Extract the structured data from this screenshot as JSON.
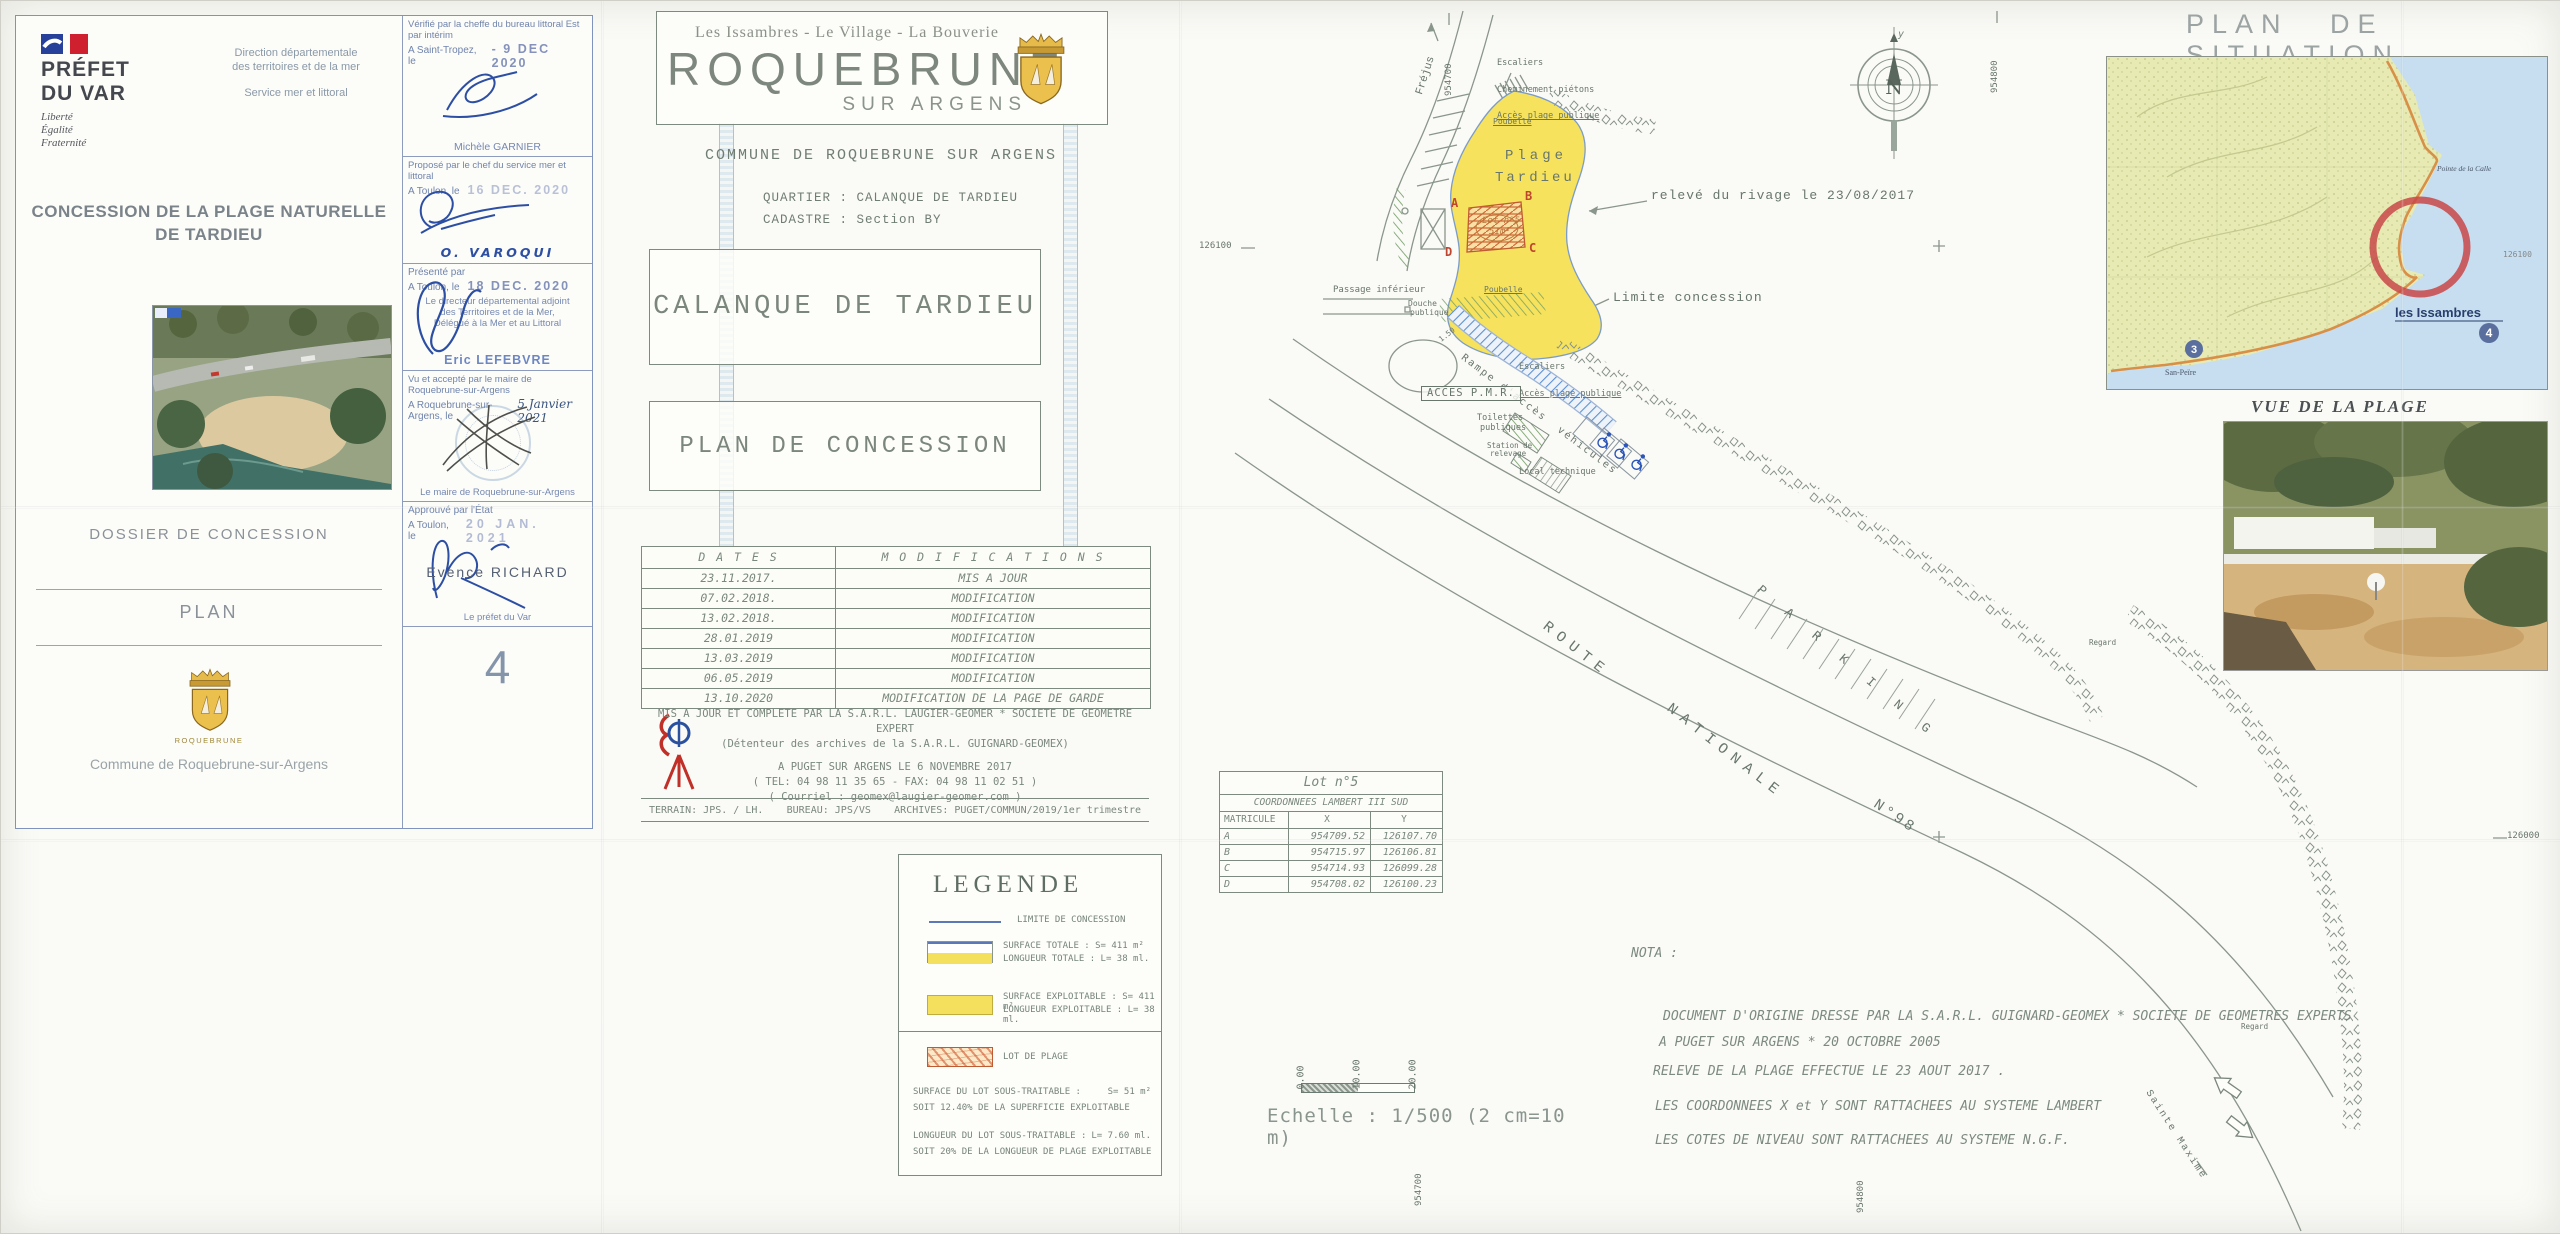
{
  "sheet": {
    "number": "4"
  },
  "prefet_block": {
    "name_line1": "PRÉFET",
    "name_line2": "DU VAR",
    "motto_1": "Liberté",
    "motto_2": "Égalité",
    "motto_3": "Fraternité",
    "direction_line1": "Direction départementale",
    "direction_line2": "des territoires et de la mer",
    "service": "Service mer et littoral",
    "title_line1": "CONCESSION DE LA PLAGE NATURELLE",
    "title_line2": "DE TARDIEU",
    "dossier": "DOSSIER DE CONCESSION",
    "plan": "PLAN",
    "logo_caption": "ROQUEBRUNE",
    "commune": "Commune de Roquebrune-sur-Argens"
  },
  "stamps": {
    "verifie": {
      "line1": "Vérifié par la cheffe du bureau littoral Est par intérim",
      "line2": "A Saint-Tropez, le",
      "date": "- 9 DEC 2020",
      "signatory": "Michèle GARNIER"
    },
    "propose": {
      "line1": "Proposé par le chef du service mer et littoral",
      "line2": "A Toulon, le",
      "date": "16 DEC. 2020",
      "signatory": "O. VAROQUI"
    },
    "presente": {
      "line1": "Présenté par",
      "line2": "A Toulon, le",
      "date": "18 DEC. 2020",
      "role": [
        "Le directeur départemental adjoint",
        "des Territoires et de la Mer,",
        "Délégué à la Mer et au Littoral"
      ],
      "signatory": "Eric LEFEBVRE"
    },
    "vu_accepte": {
      "line1": "Vu et accepté par le maire de Roquebrune-sur-Argens",
      "line2": "A Roquebrune-sur-Argens, le",
      "date_hand": "5 Janvier 2021",
      "signatory": "Le maire de Roquebrune-sur-Argens"
    },
    "approuve": {
      "line1": "Approuvé par l'État",
      "line2": "A Toulon, le",
      "date": "20 JAN. 2021",
      "signatory": "Evence RICHARD",
      "role": "Le préfet du Var"
    },
    "sheet_number": "4"
  },
  "title_block": {
    "banner_top": "Les Issambres - Le Village - La Bouverie",
    "banner_name": "ROQUEBRUNE",
    "banner_sub": "SUR ARGENS",
    "commune": "COMMUNE DE ROQUEBRUNE SUR ARGENS",
    "quartier": "QUARTIER : CALANQUE DE TARDIEU",
    "cadastre": "CADASTRE : Section BY",
    "main_title": "CALANQUE DE TARDIEU",
    "subtitle": "PLAN DE CONCESSION"
  },
  "modifications": {
    "header_dates": "D A T E S",
    "header_modifications": "M O D I F I C A T I O N S",
    "rows": [
      {
        "date": "23.11.2017.",
        "modification": "MIS A JOUR"
      },
      {
        "date": "07.02.2018.",
        "modification": "MODIFICATION"
      },
      {
        "date": "13.02.2018.",
        "modification": "MODIFICATION"
      },
      {
        "date": "28.01.2019",
        "modification": "MODIFICATION"
      },
      {
        "date": "13.03.2019",
        "modification": "MODIFICATION"
      },
      {
        "date": "06.05.2019",
        "modification": "MODIFICATION"
      },
      {
        "date": "13.10.2020",
        "modification": "MODIFICATION DE LA PAGE DE GARDE"
      }
    ]
  },
  "surveyor": {
    "line1": "MIS A JOUR ET COMPLETE PAR LA S.A.R.L. LAUGIER-GEOMER * SOCIETE DE GEOMETRE EXPERT",
    "line2": "(Détenteur des archives de la S.A.R.L. GUIGNARD-GEOMEX)",
    "line3": "A PUGET SUR ARGENS LE 6 NOVEMBRE 2017",
    "line4": "( TEL: 04 98 11 35 65  -  FAX: 04 98 11 02 51 )",
    "line5": "( Courriel : geomex@laugier-geomer.com )",
    "terrain": "TERRAIN:  JPS. / LH.",
    "bureau": "BUREAU:  JPS/VS",
    "archives": "ARCHIVES:  PUGET/COMMUN/2019/1er trimestre"
  },
  "legend": {
    "title": "LEGENDE",
    "limite": "LIMITE DE CONCESSION",
    "surface_totale_1": "SURFACE TOTALE : S= 411 m²",
    "surface_totale_2": "LONGUEUR TOTALE : L= 38 ml.",
    "surface_exploitable_1": "SURFACE EXPLOITABLE : S= 411 m²",
    "surface_exploitable_2": "LONGUEUR EXPLOITABLE : L= 38 ml.",
    "lot_de_plage": "LOT DE PLAGE",
    "sous_surface_label": "SURFACE DU LOT SOUS-TRAITABLE :",
    "sous_surface_value": "S= 51 m²",
    "sous_surface_note": "SOIT 12.40% DE LA SUPERFICIE EXPLOITABLE",
    "sous_longueur_label": "LONGUEUR DU LOT SOUS-TRAITABLE :",
    "sous_longueur_value": "L= 7.60 ml.",
    "sous_longueur_note": "SOIT 20% DE LA LONGUEUR DE PLAGE EXPLOITABLE"
  },
  "coordinates": {
    "title": "Lot n°5",
    "subtitle": "COORDONNEES LAMBERT III SUD",
    "h_matricule": "MATRICULE",
    "h_x": "X",
    "h_y": "Y",
    "rows": [
      {
        "matricule": "A",
        "x": "954709.52",
        "y": "126107.70"
      },
      {
        "matricule": "B",
        "x": "954715.97",
        "y": "126106.81"
      },
      {
        "matricule": "C",
        "x": "954714.93",
        "y": "126099.28"
      },
      {
        "matricule": "D",
        "x": "954708.02",
        "y": "126100.23"
      }
    ]
  },
  "nota": {
    "title": "NOTA :",
    "line1": "DOCUMENT D'ORIGINE DRESSE PAR LA S.A.R.L. GUIGNARD-GEOMEX * SOCIETE DE GEOMETRES EXPERTS",
    "line2": "A PUGET SUR ARGENS * 20 OCTOBRE 2005",
    "line3": "RELEVE DE LA PLAGE EFFECTUE LE 23 AOUT 2017 .",
    "line4": "LES COORDONNEES X et Y SONT RATTACHEES AU SYSTEME LAMBERT",
    "line5": "LES COTES DE NIVEAU SONT RATTACHEES AU SYSTEME N.G.F."
  },
  "scale": {
    "tick0": "0.00",
    "tick1": "10.00",
    "tick2": "20.00",
    "caption": "Echelle : 1/500 (2 cm=10 m)"
  },
  "situation": {
    "title": "PLAN DE SITUATION",
    "place": "les Issambres",
    "place2": "San-Peïre",
    "pointe": "Pointe de la Calle",
    "coord": "126100",
    "badge4": "4",
    "badge3": "3",
    "photo_caption": "VUE DE LA PLAGE"
  },
  "plan_labels": {
    "escaliers_top": [
      "Escaliers",
      "Cheminement piétons",
      "Accès plage publique"
    ],
    "poubelle": "Poubelle",
    "plage1": "Plage",
    "plage2": "Tardieu",
    "releve": "relevé du rivage le 23/08/2017",
    "limite": "Limite concession",
    "lot_title": "Lot n°5",
    "lot_area": "51m²",
    "pt_a": "A",
    "pt_b": "B",
    "pt_c": "C",
    "pt_d": "D",
    "frejus": "Fréjus",
    "passage": "Passage inférieur",
    "douche1": "Douche",
    "douche2": "publique",
    "dim150": "1.50",
    "escaliers2": [
      "Escaliers",
      "Accès plage publique"
    ],
    "rampe": "Rampe d'accès  véhicules",
    "acces_pmr": "ACCES P.M.R.",
    "toilettes1": "Toilettes",
    "toilettes2": "publiques",
    "station1": "Station de",
    "station2": "relevage",
    "local": "Local technique",
    "route1": "ROUTE",
    "route2": "NATIONALE",
    "route3": "N°98",
    "parking": "P A R K I N G",
    "regard": "Regard",
    "sainte_maxime": "Sainte Maxime",
    "c954700": "954700",
    "c954800": "954800",
    "c126100": "126100",
    "c126000": "126000",
    "north": "N",
    "compass_y": "y"
  }
}
